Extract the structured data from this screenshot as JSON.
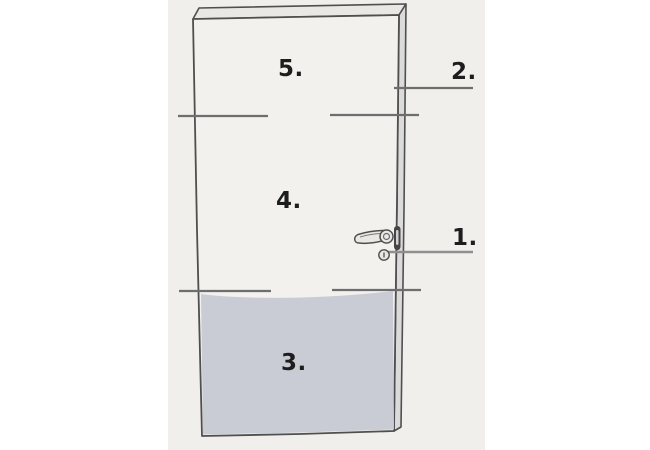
{
  "labels": {
    "callout_1": "1.",
    "callout_2": "2.",
    "section_3": "3.",
    "section_4": "4.",
    "section_5": "5."
  },
  "colors": {
    "page_background": "#ffffff",
    "photo_background": "#f0efec",
    "door_face": "#f2f1ee",
    "door_top_face": "#e9e8e5",
    "door_side_face": "#dbdbdc",
    "lower_panel": "#c9ccd5",
    "outline": "#4f4f4f",
    "divider_line": "#6e6e6e",
    "leader_line": "#8f8f8f",
    "edge_plate": "#454545",
    "hardware_fill": "#e9e8e5",
    "label_text": "#1d1d1d"
  }
}
